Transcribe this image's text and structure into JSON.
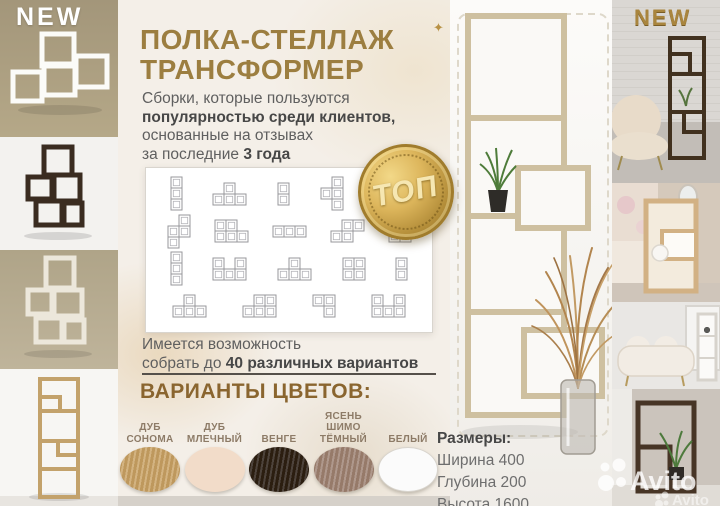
{
  "badges": {
    "new_left": "NEW",
    "new_right": "NEW",
    "top_badge": "ТОП"
  },
  "title": {
    "line1": "ПОЛКА-СТЕЛЛАЖ",
    "line2": "ТРАНСФОРМЕР"
  },
  "intro": {
    "line1": "Сборки, которые пользуются",
    "line2_bold": "популярностью среди клиентов,",
    "line3": "основанные на отзывах",
    "line4_prefix": "за последние ",
    "line4_bold": "3 года"
  },
  "note": {
    "line1": "Имеется возможность",
    "line2_prefix": "собрать до ",
    "line2_bold": "40 различных вариантов"
  },
  "colors_section": {
    "heading": "ВАРИАНТЫ ЦВЕТОВ:",
    "items": [
      {
        "label": "ДУБ\nСОНОМА",
        "hex": "#c9a265"
      },
      {
        "label": "ДУБ\nМЛЕЧНЫЙ",
        "hex": "#f2dcc9"
      },
      {
        "label": "ВЕНГЕ",
        "hex": "#261a10"
      },
      {
        "label": "ЯСЕНЬ\nШИМО\nТЁМНЫЙ",
        "hex": "#9d8173"
      },
      {
        "label": "БЕЛЫЙ",
        "hex": "#fbfbfb"
      }
    ]
  },
  "dimensions": {
    "heading": "Размеры:",
    "lines": [
      "Ширина 400",
      "Глубина 200",
      "Высота 1600"
    ]
  },
  "watermark": {
    "main": "Avito",
    "echo": "Avito"
  },
  "palette": {
    "accent_gold": "#9c7e40",
    "heading_gold": "#8a652f",
    "badge_gold": "#ddb65c",
    "text_dark": "#474747",
    "text_gray": "#5f5f5f",
    "swatch_label": "#8d7b67",
    "divider": "#55504a",
    "watermark_white": "rgba(255,255,255,0.8)"
  },
  "schematics": {
    "rows": [
      [
        [
          [
            0,
            0
          ],
          [
            0,
            1
          ],
          [
            0,
            2
          ]
        ],
        [
          [
            1,
            0
          ],
          [
            0,
            1
          ],
          [
            1,
            1
          ],
          [
            2,
            1
          ]
        ],
        [
          [
            0,
            0
          ],
          [
            0,
            1
          ]
        ],
        [
          [
            1,
            0
          ],
          [
            0,
            1
          ],
          [
            1,
            1
          ],
          [
            1,
            2
          ]
        ],
        [
          [
            0,
            0
          ],
          [
            0,
            1
          ],
          [
            1,
            1
          ],
          [
            2,
            1
          ]
        ]
      ],
      [
        [
          [
            1,
            0
          ],
          [
            0,
            1
          ],
          [
            1,
            1
          ],
          [
            0,
            2
          ]
        ],
        [
          [
            0,
            0
          ],
          [
            1,
            0
          ],
          [
            0,
            1
          ],
          [
            1,
            1
          ],
          [
            2,
            1
          ]
        ],
        [
          [
            0,
            0
          ],
          [
            1,
            0
          ],
          [
            2,
            0
          ]
        ],
        [
          [
            1,
            0
          ],
          [
            2,
            0
          ],
          [
            0,
            1
          ],
          [
            1,
            1
          ]
        ],
        [
          [
            1,
            0
          ],
          [
            0,
            1
          ],
          [
            1,
            1
          ]
        ]
      ],
      [
        [
          [
            0,
            0
          ],
          [
            0,
            1
          ],
          [
            0,
            2
          ]
        ],
        [
          [
            0,
            0
          ],
          [
            2,
            0
          ],
          [
            0,
            1
          ],
          [
            1,
            1
          ],
          [
            2,
            1
          ]
        ],
        [
          [
            1,
            0
          ],
          [
            0,
            1
          ],
          [
            1,
            1
          ],
          [
            2,
            1
          ]
        ],
        [
          [
            0,
            0
          ],
          [
            1,
            0
          ],
          [
            0,
            1
          ],
          [
            1,
            1
          ]
        ],
        [
          [
            0,
            0
          ],
          [
            0,
            1
          ]
        ]
      ],
      [
        [
          [
            1,
            0
          ],
          [
            0,
            1
          ],
          [
            1,
            1
          ],
          [
            2,
            1
          ]
        ],
        [
          [
            1,
            0
          ],
          [
            2,
            0
          ],
          [
            0,
            1
          ],
          [
            1,
            1
          ],
          [
            2,
            1
          ]
        ],
        [
          [
            0,
            0
          ],
          [
            1,
            0
          ],
          [
            1,
            1
          ]
        ],
        [
          [
            0,
            0
          ],
          [
            2,
            0
          ],
          [
            0,
            1
          ],
          [
            1,
            1
          ],
          [
            2,
            1
          ]
        ]
      ]
    ]
  }
}
